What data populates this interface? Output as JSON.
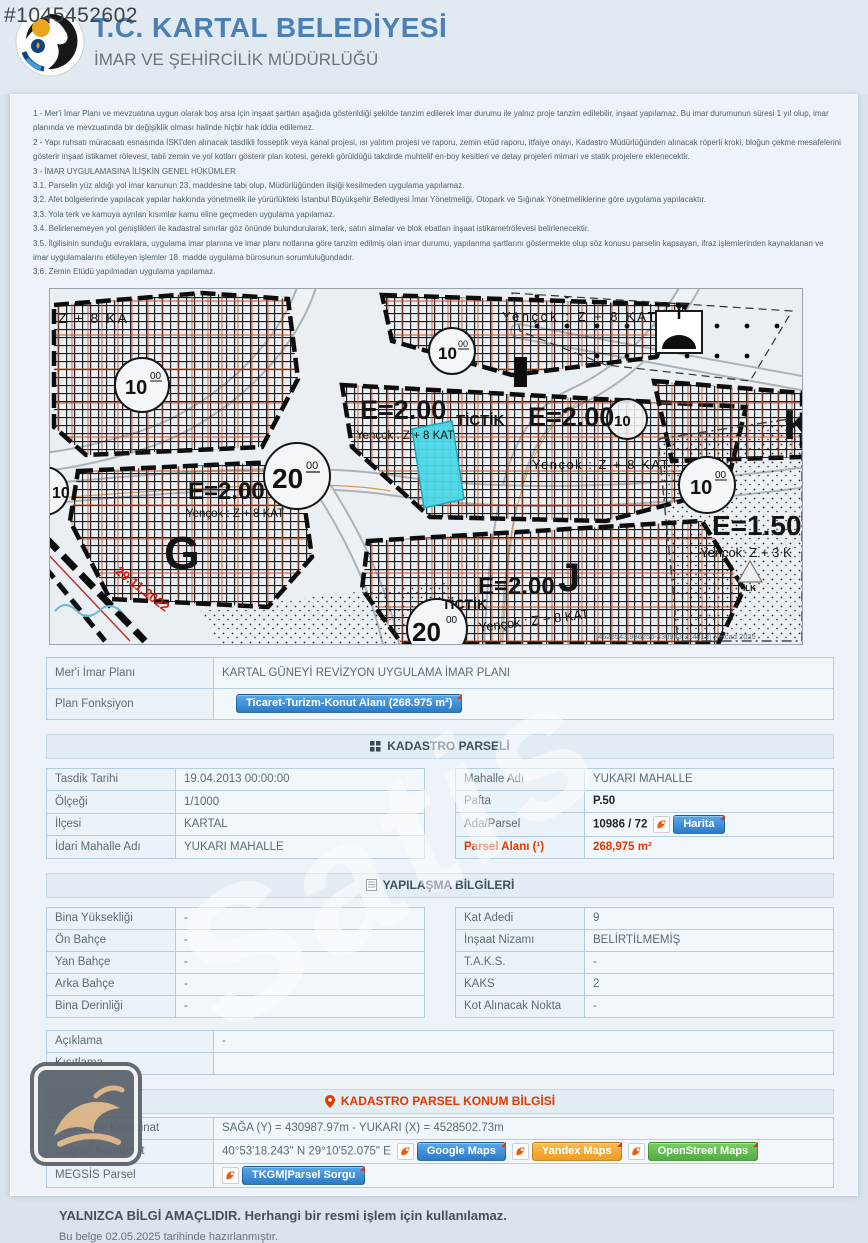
{
  "page": {
    "doc_id": "#1045452602",
    "diagonal_watermark": "Satis"
  },
  "header": {
    "title": "T.C. KARTAL BELEDİYESİ",
    "subtitle": "İMAR VE ŞEHİRCİLİK MÜDÜRLÜĞÜ"
  },
  "legal_notes": [
    "1 - Mer'i İmar Planı ve mevzuatına uygun olarak boş arsa için inşaat şartları aşağıda gösterildiği şekilde tanzim edilerek imar durumu ile yalnız proje tanzim edilebilir, inşaat yapılamaz. Bu imar durumunun süresi 1 yıl olup, imar planında ve mevzuatında bir değişiklik olması halinde hiçbir hak iddia edilemez.",
    "2 - Yapı ruhsatı müracaatı esnasında İSKİ'den alınacak tasdikli fosseptik veya kanal projesi, ısı yalıtım projesi ve raporu, zemin etüd raporu, itfaiye onayı, Kadastro Müdürlüğünden alınacak röperli kroki, bloğun çekme mesafelerini gösterir inşaat istikamet rölevesi, tabii zemin ve yol kotları gösterir plan kotesi, gerekli görüldüğü takdirde muhtelif en-boy kesitleri ve detay projeleri mimari ve statik projelere eklenecektir.",
    "3 - İMAR UYGULAMASINA İLİŞKİN GENEL HÜKÜMLER",
    "3.1. Parselin yüz aldığı yol imar kanunun 23. maddesine tabi olup, Müdürlüğünden ilişiği kesilmeden uygulama yapılamaz.",
    "3.2. Afet bölgelerinde yapılacak yapılar hakkında yönetmelik ile yürürlükteki İstanbul Büyükşehir Belediyesi İmar Yönetmeliği, Otopark ve Sığınak Yönetmeliklerine göre uygulama yapılacaktır.",
    "3.3. Yola terk ve kamuya ayrılan kısımlar kamu eline geçmeden uygulama yapılamaz.",
    "3.4. Belirlenemeyen yol genişlikleri ile kadastral sınırlar göz önünde bulundurularak, terk, satın almalar ve blok ebatları inşaat istikametrölevesi belirlenecektir.",
    "3.5. İlgilisinin sunduğu evraklara, uygulama imar planına ve imar planı notlarına göre tanzim edilmiş olan imar durumu, yapılanma şartlarını göstermekte olup söz konusu parselin kapsayan, ifraz işlemlerinden kaynaklanan ve imar uygulamalarını etkileyen işlemler 18. madde uygulama bürosunun sorumluluğundadır.",
    "3.6. Zemin Etüdü yapılmadan uygulama yapılamaz."
  ],
  "map": {
    "labels": {
      "z8_partial": "Z + 8 KA",
      "yencok_z8": "Yençok : Z + 8 KAT",
      "yencok_z3": "Yençok: Z + 3 K",
      "e200": "E=2.00",
      "e150": "E=1.50",
      "tictik": "TİCTİK",
      "letter_g": "G",
      "letter_j": "J",
      "letter_k": "K",
      "ilk": "İLK",
      "survey_date": "29.11.2022",
      "road_10": "10",
      "road_20": "20",
      "road_00": "00",
      "netcad": "[4528543.936256-430943.314813] Netcad 2025"
    }
  },
  "plan_table": {
    "rows": [
      {
        "label": "Mer'i İmar Planı",
        "value": "KARTAL GÜNEYİ REVİZYON UYGULAMA İMAR PLANI"
      },
      {
        "label": "Plan Fonksiyon",
        "value": "Ticaret-Turizm-Konut Alanı (268.975 m²)"
      }
    ]
  },
  "kadastro": {
    "section_title": "KADASTRO PARSELİ",
    "left_rows": [
      {
        "label": "Tasdik Tarihi",
        "value": "19.04.2013 00:00:00"
      },
      {
        "label": "Ölçeği",
        "value": "1/1000"
      },
      {
        "label": "İlçesi",
        "value": "KARTAL"
      },
      {
        "label": "İdari Mahalle Adı",
        "value": "YUKARI MAHALLE"
      }
    ],
    "right_rows": [
      {
        "label": "Mahalle Adı",
        "value": "YUKARI MAHALLE"
      },
      {
        "label": "Pafta",
        "value": "P.50"
      },
      {
        "label": "Ada/Parsel",
        "value": "10986 / 72",
        "button": "Harita"
      },
      {
        "label": "Parsel Alanı (¹)",
        "value": "268,975 m²"
      }
    ]
  },
  "yapilasma": {
    "section_title": "YAPILAŞMA BİLGİLERİ",
    "left_rows": [
      {
        "label": "Bina Yüksekliği",
        "value": "-"
      },
      {
        "label": "Ön Bahçe",
        "value": "-"
      },
      {
        "label": "Yan Bahçe",
        "value": "-"
      },
      {
        "label": "Arka Bahçe",
        "value": "-"
      },
      {
        "label": "Bina Derinliği",
        "value": "-"
      }
    ],
    "right_rows": [
      {
        "label": "Kat Adedi",
        "value": "9"
      },
      {
        "label": "İnşaat Nizamı",
        "value": "BELİRTİLMEMİŞ"
      },
      {
        "label": "T.A.K.S.",
        "value": "-"
      },
      {
        "label": "KAKS",
        "value": "2"
      },
      {
        "label": "Kot Alınacak Nokta",
        "value": "-"
      }
    ]
  },
  "notes": {
    "rows": [
      {
        "label": "Açıklama",
        "value": "-"
      },
      {
        "label": "Kısıtlama",
        "value": ""
      }
    ]
  },
  "konum": {
    "section_title": "KADASTRO PARSEL KONUM BİLGİSİ",
    "rows": [
      {
        "label": "Kartezyen Koordinat",
        "value": "SAĞA (Y) = 430987.97m - YUKARI (X) = 4528502.73m"
      },
      {
        "label": "Coğrafi Koordinat",
        "value": "40°53'18.243\" N 29°10'52.075\" E",
        "buttons": [
          "Google Maps",
          "Yandex Maps",
          "OpenStreet Maps"
        ]
      },
      {
        "label": "MEGSİS Parsel",
        "buttons": [
          "TKGM|Parsel Sorgu"
        ]
      }
    ]
  },
  "footer": {
    "warning": "YALNIZCA BİLGİ AMAÇLIDIR. Herhangi bir resmi işlem için kullanılamaz.",
    "generated": "Bu belge 02.05.2025 tarihinde hazırlanmıştır."
  },
  "colors": {
    "accent_blue": "#2a7ac6",
    "alert_red": "#e23a00",
    "parcel_highlight": "#4cd7e8",
    "yandex_orange": "#ef9c22",
    "osm_green": "#53ab44"
  }
}
